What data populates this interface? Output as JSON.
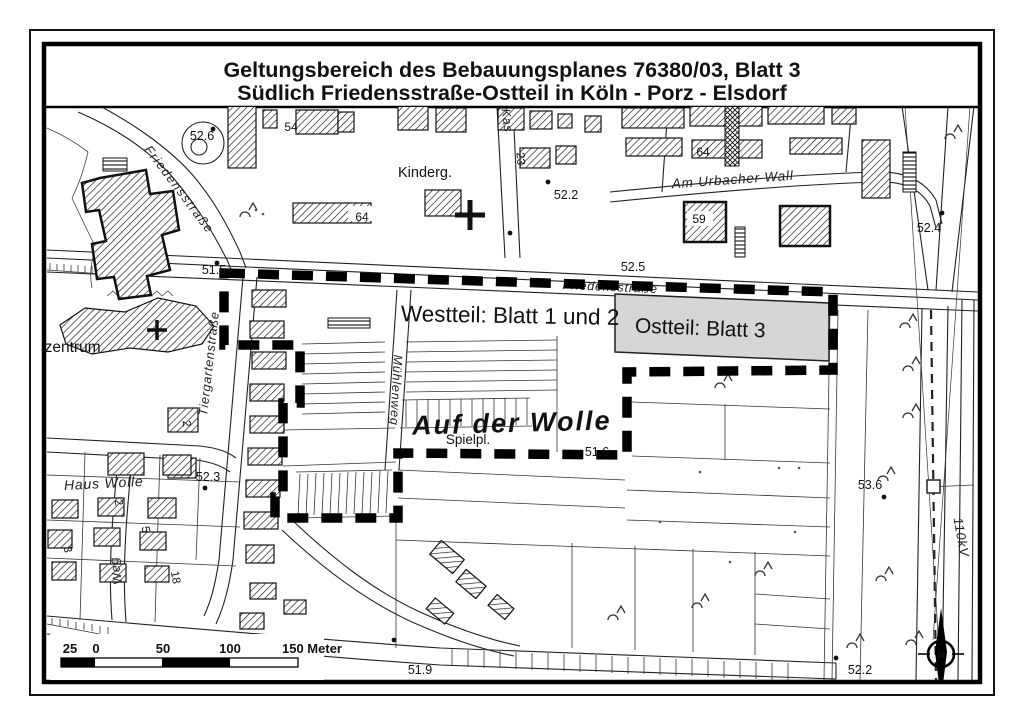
{
  "page": {
    "title_line1": "Geltungsbereich des Bebauungsplanes 76380/03, Blatt 3",
    "title_line2": "Südlich Friedensstraße-Ostteil in Köln - Porz - Elsdorf"
  },
  "map": {
    "region_labels": {
      "westteil": "Westteil: Blatt 1 und 2",
      "ostteil": "Ostteil: Blatt 3",
      "auf_der_wolle": "Auf der Wolle",
      "zentrum": "nzentrum",
      "haus_wolle": "Haus Wolle",
      "kindergarten": "Kinderg.",
      "spielplatz_1": "Spielpl.",
      "spielplatz_2": "Spielpl."
    },
    "streets": {
      "friedensstrasse_nw": "Friedensstraße",
      "friedensstrasse_mid": "Friedensstraße",
      "am_urbacher_wall": "Am Urbacher Wall",
      "tiergartenstrasse": "Tiergartenstraße",
      "muehlenweg": "Mühlenweg",
      "weg": "Weg",
      "kastanien": "Kas",
      "power_line": "110kV"
    },
    "elevations": [
      "52.6",
      "52.2",
      "52.5",
      "52.4",
      "51.5",
      "51.6",
      "52.3",
      "53.6",
      "51.9",
      "52.2"
    ],
    "house_numbers": {
      "n54": "54",
      "n64_a": "64",
      "n64_b": "64",
      "n59": "59",
      "n23": "23",
      "n5_a": "5",
      "n2_a": "2",
      "n2_b": "2",
      "n5_b": "5",
      "n3": "3",
      "n18": "18"
    },
    "north_arrow_label": "N",
    "colors": {
      "ostteil_box_fill": "#d6d6d6",
      "auf_der_wolle_text": "#6b6b6b",
      "ink": "#111111"
    }
  },
  "scale_bar": {
    "labels": [
      "25",
      "0",
      "50",
      "100",
      "150 Meter"
    ]
  }
}
